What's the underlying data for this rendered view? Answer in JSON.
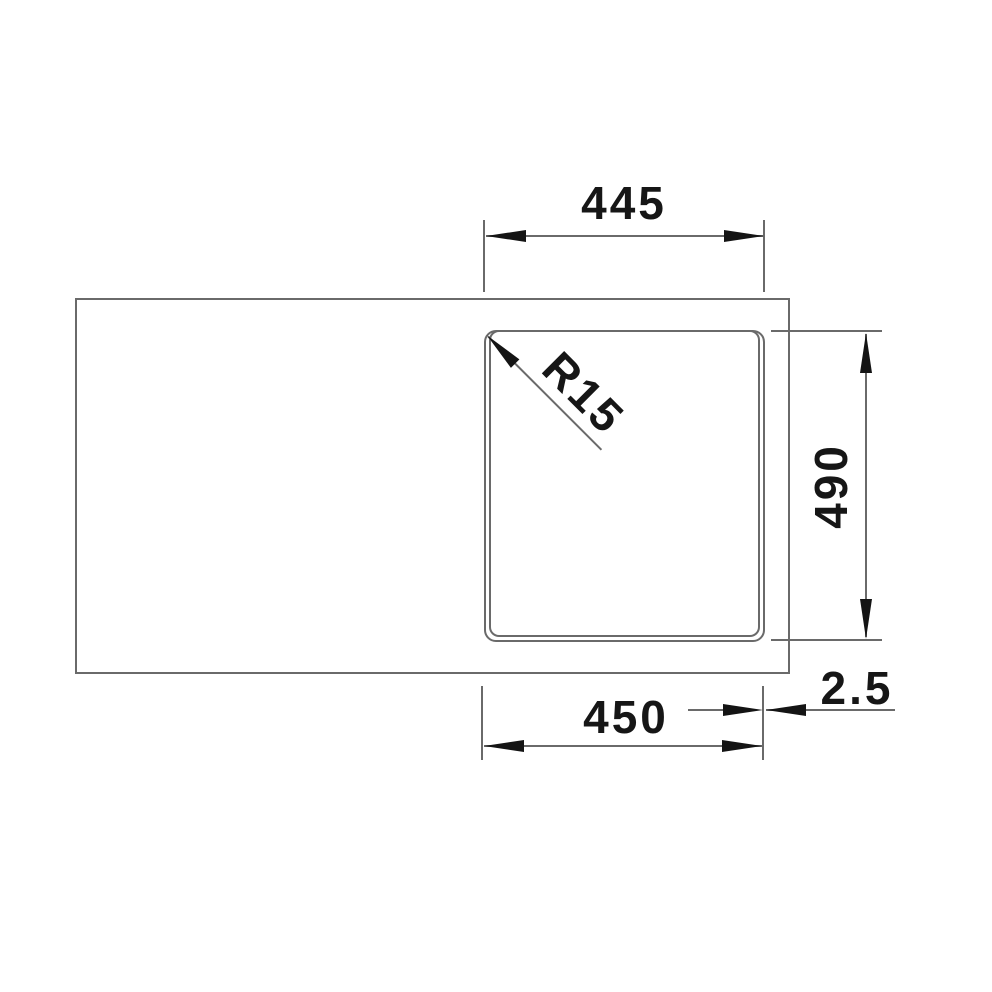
{
  "drawing": {
    "kind": "technical-dimension-drawing",
    "view": "top-view-sink-with-bowl",
    "background_color": "#ffffff",
    "line_color": "#6a6a6a",
    "ink_color": "#161616"
  },
  "dimensions": {
    "top_width": {
      "value": "445",
      "orientation": "horizontal"
    },
    "bowl_height": {
      "value": "490",
      "orientation": "vertical"
    },
    "bottom_width": {
      "value": "450",
      "orientation": "horizontal"
    },
    "edge_offset": {
      "value": "2.5",
      "orientation": "horizontal"
    },
    "corner_radius": {
      "value": "R15",
      "orientation": "diagonal-45deg"
    }
  }
}
